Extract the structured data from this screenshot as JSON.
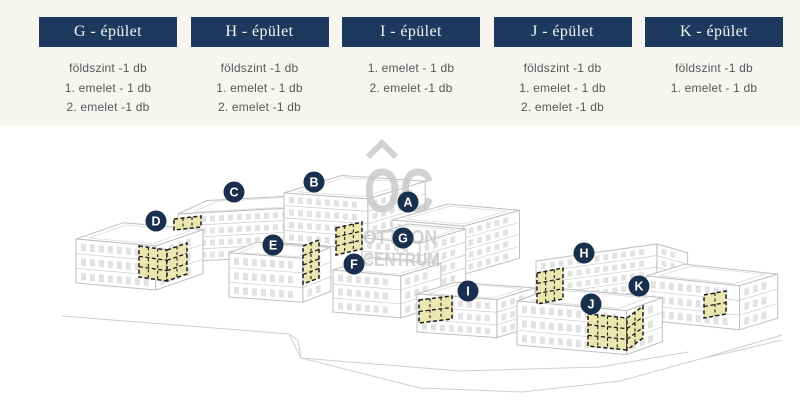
{
  "buildings_panel": {
    "columns": [
      {
        "id": "G",
        "button_label": "G - épület",
        "availability": [
          "földszint -1 db",
          "1. emelet - 1 db",
          "2. emelet -1 db"
        ]
      },
      {
        "id": "H",
        "button_label": "H - épület",
        "availability": [
          "földszint -1 db",
          "1. emelet - 1 db",
          "2. emelet -1 db"
        ]
      },
      {
        "id": "I",
        "button_label": "I - épület",
        "availability": [
          "1. emelet - 1 db",
          "2. emelet -1 db"
        ]
      },
      {
        "id": "J",
        "button_label": "J - épület",
        "availability": [
          "földszint -1 db",
          "1. emelet - 1 db",
          "2. emelet -1 db"
        ]
      },
      {
        "id": "K",
        "button_label": "K - épület",
        "availability": [
          "földszint -1 db",
          "1. emelet - 1 db"
        ]
      }
    ]
  },
  "map": {
    "watermark": {
      "logo": "OC",
      "line1": "OTTHON",
      "line2": "CENTRUM"
    },
    "badges": [
      {
        "letter": "A",
        "x": 408,
        "y": 202
      },
      {
        "letter": "B",
        "x": 314,
        "y": 182
      },
      {
        "letter": "C",
        "x": 234,
        "y": 192
      },
      {
        "letter": "D",
        "x": 156,
        "y": 221
      },
      {
        "letter": "E",
        "x": 273,
        "y": 245
      },
      {
        "letter": "F",
        "x": 354,
        "y": 264
      },
      {
        "letter": "G",
        "x": 403,
        "y": 238
      },
      {
        "letter": "H",
        "x": 584,
        "y": 253
      },
      {
        "letter": "I",
        "x": 468,
        "y": 291
      },
      {
        "letter": "J",
        "x": 591,
        "y": 304
      },
      {
        "letter": "K",
        "x": 639,
        "y": 286
      }
    ]
  },
  "colors": {
    "band_bg": "#f7f5ef",
    "accent_navy": "#1d3a5e",
    "badge_navy": "#18304e",
    "highlight_yellow": "#ebe6ac",
    "line_gray": "#c7c7c7",
    "text_gray": "#55585d"
  }
}
